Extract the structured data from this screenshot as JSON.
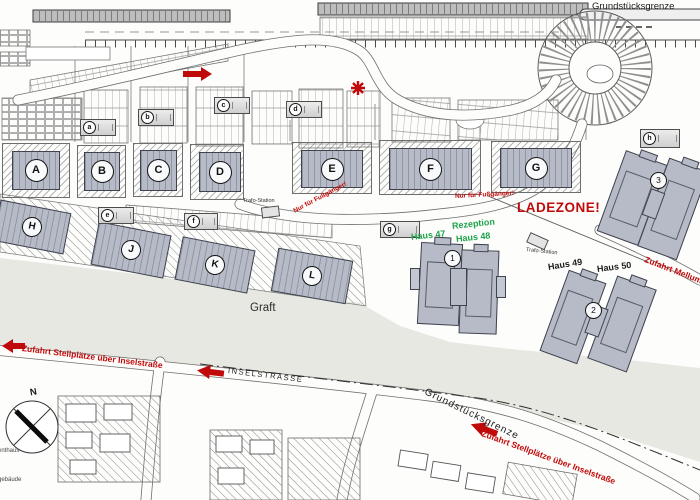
{
  "boundary_labels": {
    "top_right": "Grundstücksgrenze",
    "bottom": "Grundstücksgrenze"
  },
  "map_labels": {
    "inselstrasse": "INSELSTRASSE",
    "graft": "Graft"
  },
  "red_annotations": {
    "ladezone": "LADEZONE!",
    "pedestrians_only_west": "Nur für Fußgänger!",
    "pedestrians_only_center": "Nur für Fußgänger!",
    "access_parking_west": "Zufahrt Stellplätze über Inselstraße",
    "access_parking_southeast": "Zufahrt Stellplätze über Inselstraße",
    "access_mellumweg": "Zufahrt Mellumweg"
  },
  "green_annotations": {
    "haus47": "Haus 47",
    "rezeption": "Rezeption",
    "haus48": "Haus 48"
  },
  "house_labels": {
    "haus49": "Haus 49",
    "haus50": "Haus 50"
  },
  "utility_labels": {
    "trafo_west": "Trafo-Station",
    "trafo_east": "Trafo-Station"
  },
  "building_blocks_row1": [
    {
      "letter": "A"
    },
    {
      "letter": "B"
    },
    {
      "letter": "C"
    },
    {
      "letter": "D"
    },
    {
      "letter": "E"
    },
    {
      "letter": "F"
    },
    {
      "letter": "G"
    }
  ],
  "building_blocks_row2": [
    {
      "letter": "H"
    },
    {
      "letter": "J"
    },
    {
      "letter": "K"
    },
    {
      "letter": "L"
    }
  ],
  "small_units": [
    {
      "letter": "a"
    },
    {
      "letter": "b"
    },
    {
      "letter": "c"
    },
    {
      "letter": "d"
    },
    {
      "letter": "e"
    },
    {
      "letter": "f"
    },
    {
      "letter": "g"
    },
    {
      "letter": "h"
    }
  ],
  "numbered_buildings": [
    {
      "number": "1"
    },
    {
      "number": "2"
    },
    {
      "number": "3"
    }
  ],
  "compass": {
    "north": "N"
  },
  "edge_labels": {
    "left_upper": "enthaus",
    "left_lower": "gebäude"
  },
  "colors": {
    "annotation_red": "#c00a0a",
    "annotation_green": "#1fa34c",
    "building_fill": "#b6bbc7",
    "ground_band": "#e8e8e2"
  }
}
